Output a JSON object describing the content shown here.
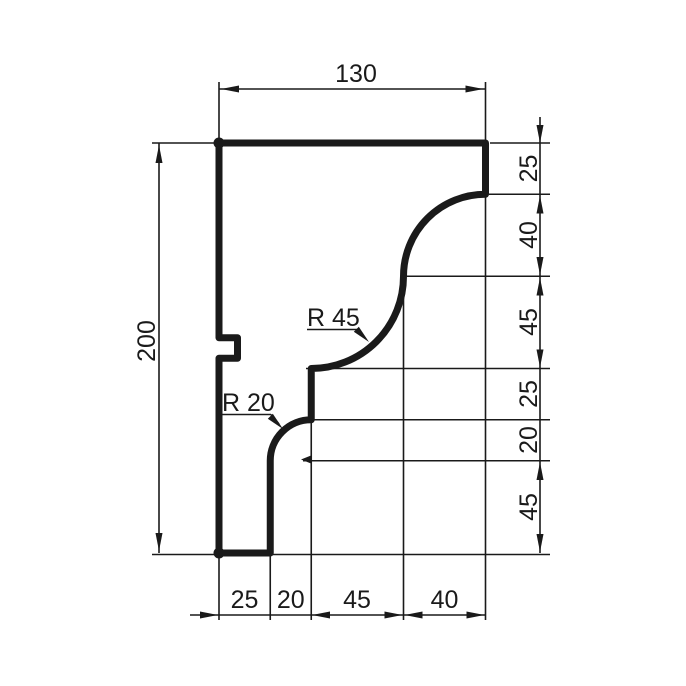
{
  "dims": {
    "top": "130",
    "left": "200",
    "right": [
      "25",
      "40",
      "45",
      "25",
      "20",
      "45"
    ],
    "bottom": [
      "25",
      "20",
      "45",
      "40"
    ]
  },
  "radii": {
    "r45": "R 45",
    "r20": "R 20"
  },
  "colors": {
    "line": "#1a1a1a",
    "background": "#ffffff"
  }
}
